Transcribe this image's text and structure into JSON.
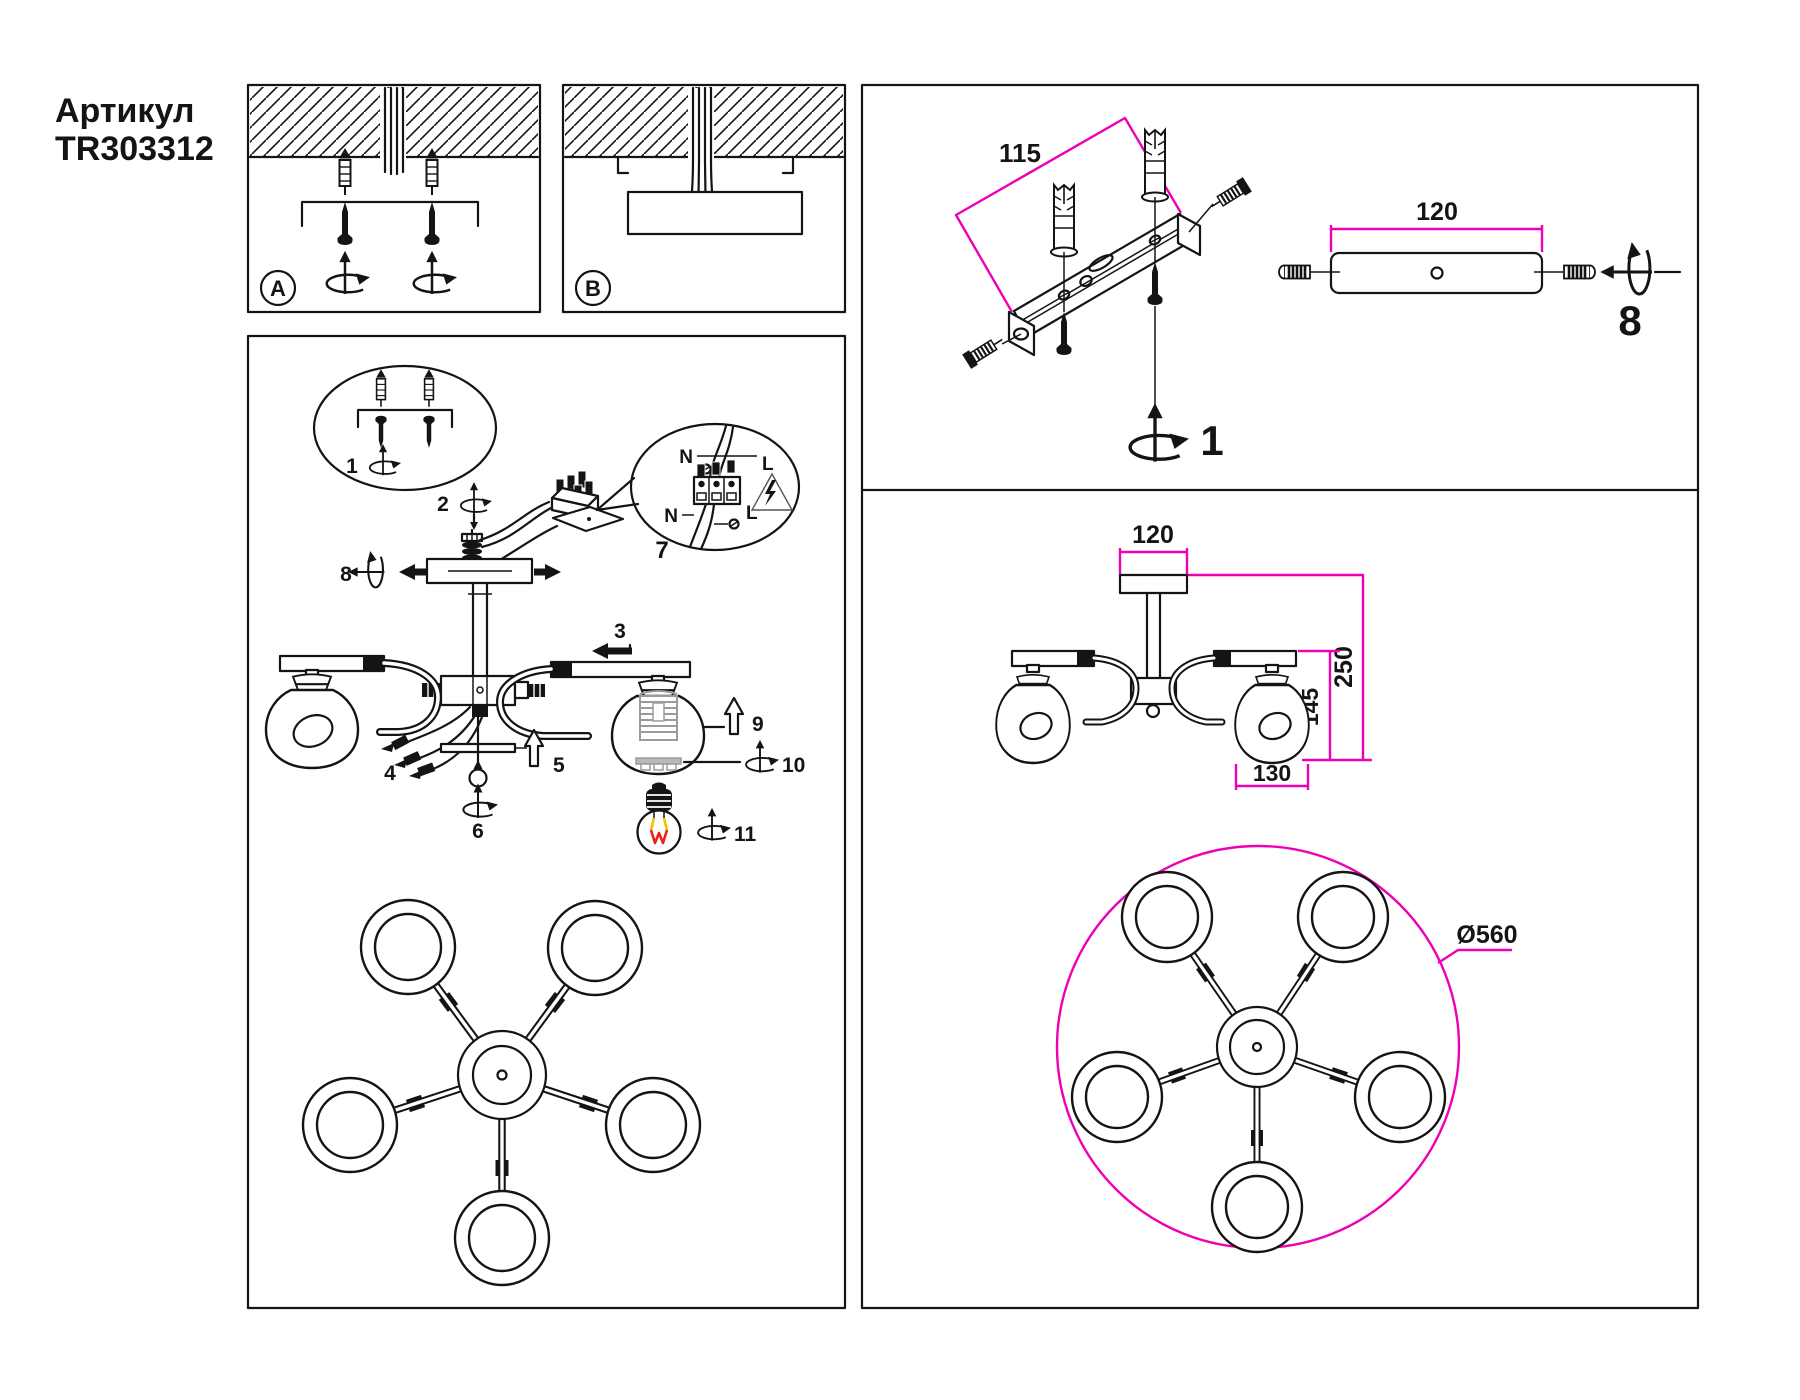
{
  "article": {
    "label": "Артикул",
    "number": "TR303312"
  },
  "panel_a": {
    "label": "A"
  },
  "panel_b": {
    "label": "B"
  },
  "steps": {
    "s1": "1",
    "s2": "2",
    "s3": "3",
    "s4": "4",
    "s5": "5",
    "s6": "6",
    "s7": "7",
    "s8": "8",
    "s9": "9",
    "s10": "10",
    "s11": "11"
  },
  "wiring": {
    "n_top": "N",
    "l_top": "L",
    "n_bottom": "N",
    "l_bottom": "L"
  },
  "mounting_panel": {
    "dim_hole_spacing": "115",
    "dim_plate_width": "120",
    "step_bracket": "1",
    "step_setscrew": "8"
  },
  "dimensions_panel": {
    "canopy_width": "120",
    "total_height": "250",
    "shade_height": "145",
    "shade_width": "130",
    "fixture_diameter": "Ø560"
  },
  "colors": {
    "accent_magenta": "#ee00b4",
    "line_black": "#141414",
    "filament_red": "#e8231a",
    "filament_yellow": "#f2c200",
    "socket_gray": "#9b9b9b"
  }
}
